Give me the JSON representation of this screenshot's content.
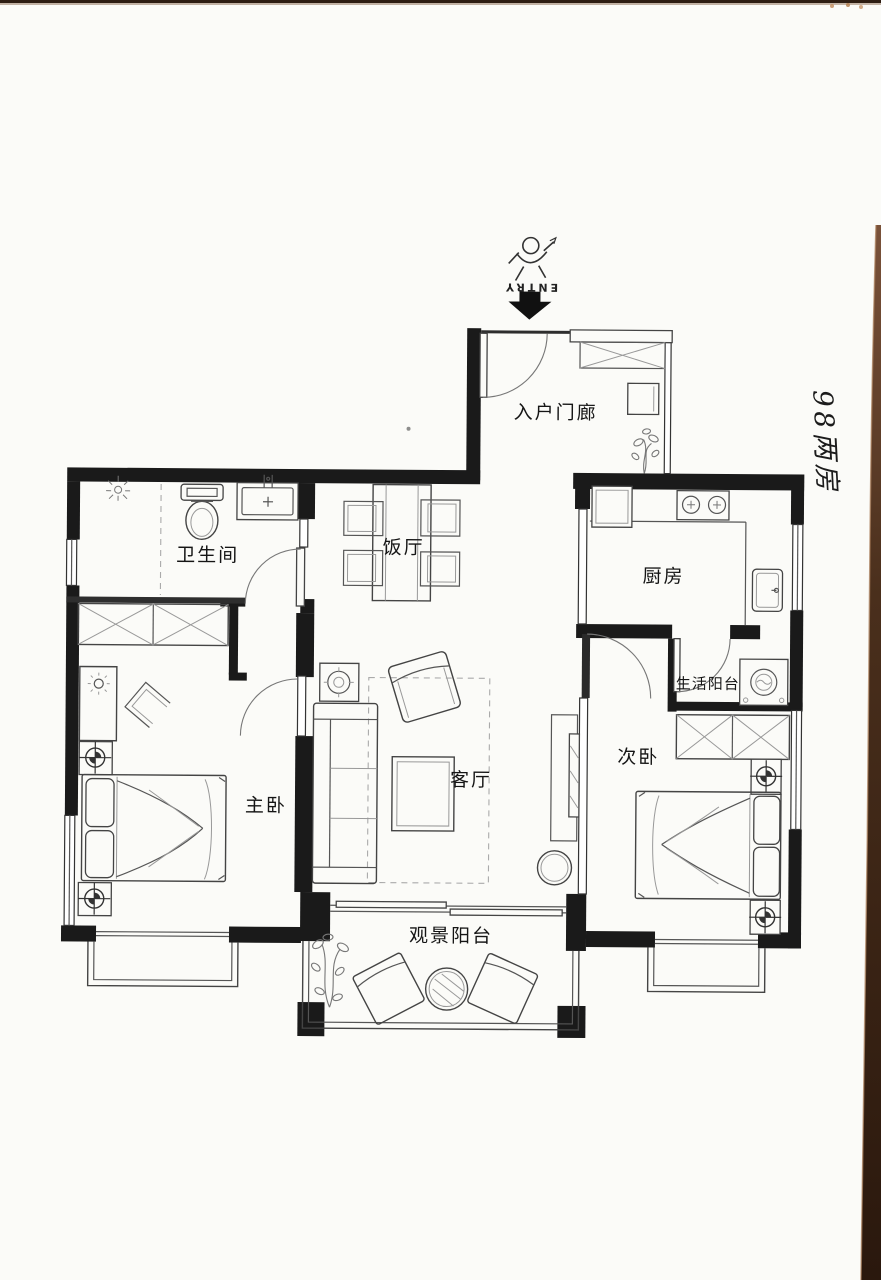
{
  "scan": {
    "handwritten_note": "98两房",
    "edge_color": "#5b3c28"
  },
  "entry": {
    "direction_label": "ENTRY"
  },
  "rooms": [
    {
      "id": "entry-porch",
      "label": "入户门廊"
    },
    {
      "id": "bathroom",
      "label": "卫生间"
    },
    {
      "id": "dining-room",
      "label": "饭厅"
    },
    {
      "id": "kitchen",
      "label": "厨房"
    },
    {
      "id": "service-balcony",
      "label": "生活阳台"
    },
    {
      "id": "master-bedroom",
      "label": "主卧"
    },
    {
      "id": "living-room",
      "label": "客厅"
    },
    {
      "id": "second-bedroom",
      "label": "次卧"
    },
    {
      "id": "view-balcony",
      "label": "观景阳台"
    }
  ],
  "colors": {
    "wall": "#1a1a1a",
    "furniture_line": "#555555",
    "paper": "#fbfbf8"
  }
}
